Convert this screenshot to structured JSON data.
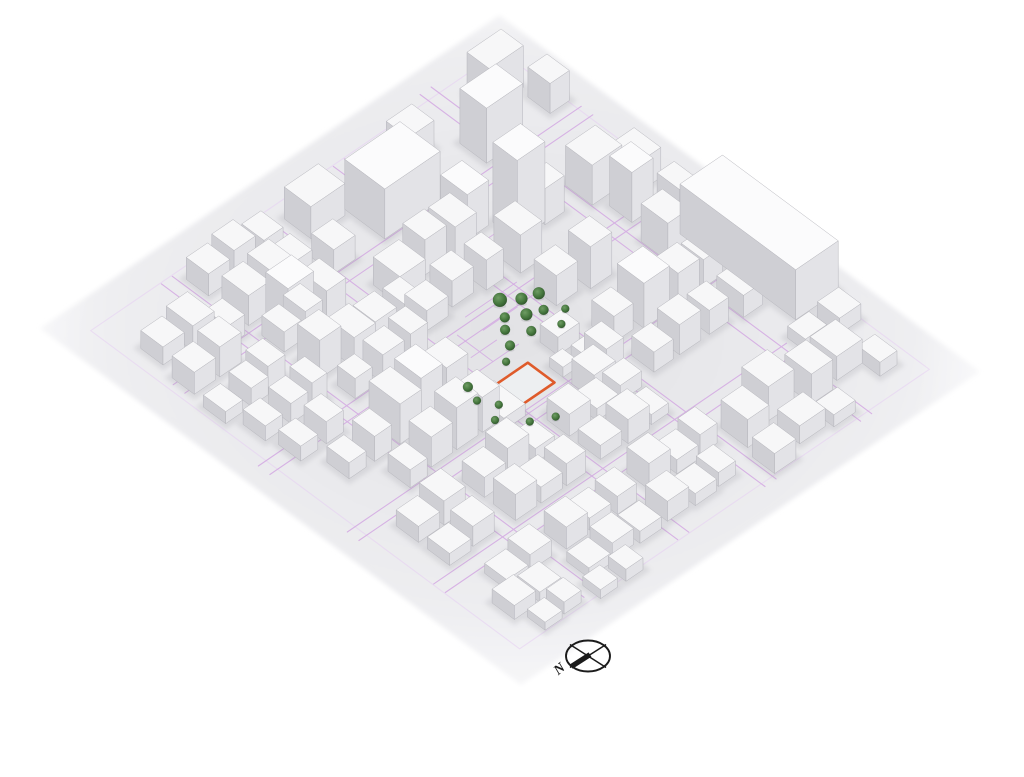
{
  "meta": {
    "description": "Axonometric 3D city-context massing model with highlighted site parcel, central tree cluster and north compass",
    "view": "aerial-axonometric"
  },
  "compass": {
    "cx": 588,
    "cy": 656,
    "rx": 22,
    "ry": 15.5,
    "label": "N"
  },
  "palette": {
    "background": "#ffffff",
    "ground_center": "#e2e2e5",
    "ground_mid": "#ededf0",
    "ground_edge": "#fbfbfc",
    "building_top": "#f7f7f8",
    "building_top_tall": "#fbfbfc",
    "building_left": "#cfcfd4",
    "building_right": "#e3e3e7",
    "building_edge": "#b6b6bc",
    "road": "#d2a4e2",
    "road_light": "#e6cdf2",
    "site_outline": "#df5b2b",
    "site_fill": "#edeff1",
    "tree": "#47793f",
    "tree_light": "#6f9c64",
    "tree_dark": "#2c5029",
    "shadow": "#8f8f98",
    "compass_ink": "#1b1b1b"
  },
  "projection": {
    "left": [
      75,
      330
    ],
    "top": [
      500,
      40
    ],
    "right": [
      920,
      330
    ],
    "bottom": [
      520,
      660
    ]
  },
  "site": {
    "u": 0.42,
    "v": 0.54,
    "w": 0.08,
    "d": 0.06
  },
  "roads": {
    "v_streets": [
      {
        "v": 0.205,
        "u0": 0.03,
        "u1": 0.99
      },
      {
        "v": 0.425,
        "u0": 0.0,
        "u1": 0.99
      },
      {
        "v": 0.625,
        "u0": 0.0,
        "u1": 0.87
      },
      {
        "v": 0.8,
        "u0": 0.02,
        "u1": 0.85
      }
    ],
    "u_streets": [
      {
        "u": 0.195,
        "v0": 0.02,
        "v1": 0.97
      },
      {
        "u": 0.405,
        "v0": 0.03,
        "v1": 0.98
      },
      {
        "u": 0.6,
        "v0": 0.02,
        "v1": 0.99
      },
      {
        "u": 0.825,
        "v0": 0.0,
        "v1": 0.99
      }
    ],
    "perimeter_inset": 0.018
  },
  "details": [
    [
      0.5,
      0.4,
      0.62,
      0.4
    ],
    [
      0.5,
      0.44,
      0.58,
      0.44
    ],
    [
      0.42,
      0.5,
      0.52,
      0.5
    ],
    [
      0.44,
      0.47,
      0.5,
      0.47
    ],
    [
      0.55,
      0.55,
      0.6,
      0.55
    ],
    [
      0.36,
      0.62,
      0.46,
      0.62
    ],
    [
      0.52,
      0.6,
      0.52,
      0.66
    ],
    [
      0.58,
      0.5,
      0.58,
      0.56
    ],
    [
      0.62,
      0.3,
      0.7,
      0.3
    ],
    [
      0.3,
      0.44,
      0.38,
      0.44
    ],
    [
      0.46,
      0.42,
      0.46,
      0.5
    ],
    [
      0.6,
      0.58,
      0.66,
      0.58
    ]
  ],
  "trees": [
    [
      0.56,
      0.42,
      7
    ],
    [
      0.59,
      0.44,
      6
    ],
    [
      0.62,
      0.45,
      6
    ],
    [
      0.54,
      0.45,
      5
    ],
    [
      0.57,
      0.47,
      6
    ],
    [
      0.6,
      0.48,
      5
    ],
    [
      0.52,
      0.47,
      5
    ],
    [
      0.55,
      0.5,
      5
    ],
    [
      0.5,
      0.5,
      5
    ],
    [
      0.47,
      0.52,
      4
    ],
    [
      0.38,
      0.52,
      5
    ],
    [
      0.37,
      0.55,
      4
    ],
    [
      0.39,
      0.58,
      4
    ],
    [
      0.36,
      0.6,
      4
    ],
    [
      0.4,
      0.64,
      4
    ],
    [
      0.44,
      0.66,
      4
    ],
    [
      0.6,
      0.52,
      4
    ],
    [
      0.63,
      0.5,
      4
    ]
  ],
  "buildings": [
    [
      0.87,
      0.05,
      0.08,
      0.05,
      42
    ],
    [
      0.78,
      0.12,
      0.085,
      0.06,
      55
    ],
    [
      0.94,
      0.12,
      0.045,
      0.05,
      30
    ],
    [
      0.69,
      0.28,
      0.065,
      0.055,
      80
    ],
    [
      0.75,
      0.3,
      0.045,
      0.04,
      36
    ],
    [
      0.53,
      0.1,
      0.13,
      0.09,
      50
    ],
    [
      0.44,
      0.05,
      0.08,
      0.06,
      32
    ],
    [
      0.68,
      0.05,
      0.06,
      0.05,
      28
    ],
    [
      0.63,
      0.22,
      0.05,
      0.06,
      45
    ],
    [
      0.25,
      0.19,
      0.06,
      0.05,
      48
    ],
    [
      0.84,
      0.3,
      0.07,
      0.06,
      40
    ],
    [
      0.86,
      0.38,
      0.05,
      0.05,
      50
    ],
    [
      0.92,
      0.33,
      0.05,
      0.06,
      30
    ],
    [
      0.93,
      0.42,
      0.04,
      0.05,
      26
    ],
    [
      0.84,
      0.47,
      0.05,
      0.06,
      38
    ],
    [
      0.9,
      0.5,
      0.1,
      0.26,
      50
    ],
    [
      0.84,
      0.56,
      0.045,
      0.05,
      28
    ],
    [
      0.84,
      0.64,
      0.045,
      0.06,
      22
    ],
    [
      0.86,
      0.78,
      0.05,
      0.04,
      12
    ],
    [
      0.93,
      0.78,
      0.05,
      0.05,
      16
    ],
    [
      0.85,
      0.84,
      0.06,
      0.06,
      24
    ],
    [
      0.78,
      0.85,
      0.05,
      0.06,
      30
    ],
    [
      0.7,
      0.83,
      0.06,
      0.06,
      34
    ],
    [
      0.63,
      0.85,
      0.05,
      0.06,
      28
    ],
    [
      0.91,
      0.89,
      0.04,
      0.05,
      14
    ],
    [
      0.7,
      0.91,
      0.06,
      0.05,
      18
    ],
    [
      0.62,
      0.93,
      0.05,
      0.05,
      20
    ],
    [
      0.77,
      0.93,
      0.05,
      0.04,
      12
    ],
    [
      0.7,
      0.55,
      0.06,
      0.06,
      45
    ],
    [
      0.77,
      0.57,
      0.05,
      0.05,
      38
    ],
    [
      0.64,
      0.33,
      0.05,
      0.06,
      38
    ],
    [
      0.7,
      0.44,
      0.05,
      0.05,
      42
    ],
    [
      0.63,
      0.43,
      0.05,
      0.05,
      30
    ],
    [
      0.64,
      0.55,
      0.045,
      0.05,
      26
    ],
    [
      0.7,
      0.64,
      0.05,
      0.05,
      30
    ],
    [
      0.77,
      0.64,
      0.045,
      0.05,
      24
    ],
    [
      0.64,
      0.64,
      0.045,
      0.05,
      20
    ],
    [
      0.44,
      0.25,
      0.06,
      0.06,
      28
    ],
    [
      0.52,
      0.24,
      0.05,
      0.05,
      35
    ],
    [
      0.57,
      0.25,
      0.05,
      0.06,
      40
    ],
    [
      0.43,
      0.33,
      0.05,
      0.05,
      20
    ],
    [
      0.5,
      0.32,
      0.05,
      0.05,
      26
    ],
    [
      0.57,
      0.33,
      0.04,
      0.05,
      30
    ],
    [
      0.55,
      0.52,
      0.05,
      0.04,
      18
    ],
    [
      0.52,
      0.57,
      0.03,
      0.03,
      10
    ],
    [
      0.56,
      0.58,
      0.035,
      0.04,
      14
    ],
    [
      0.36,
      0.55,
      0.05,
      0.07,
      12
    ],
    [
      0.52,
      0.62,
      0.05,
      0.05,
      25
    ],
    [
      0.57,
      0.6,
      0.04,
      0.05,
      30
    ],
    [
      0.55,
      0.66,
      0.05,
      0.04,
      16
    ],
    [
      0.44,
      0.64,
      0.04,
      0.04,
      8
    ],
    [
      0.22,
      0.04,
      0.05,
      0.05,
      22
    ],
    [
      0.28,
      0.04,
      0.05,
      0.05,
      28
    ],
    [
      0.34,
      0.05,
      0.045,
      0.05,
      24
    ],
    [
      0.22,
      0.12,
      0.05,
      0.06,
      30
    ],
    [
      0.28,
      0.12,
      0.05,
      0.05,
      35
    ],
    [
      0.34,
      0.12,
      0.04,
      0.05,
      26
    ],
    [
      0.22,
      0.21,
      0.04,
      0.05,
      20
    ],
    [
      0.27,
      0.21,
      0.04,
      0.05,
      26
    ],
    [
      0.32,
      0.2,
      0.045,
      0.06,
      32
    ],
    [
      0.22,
      0.29,
      0.05,
      0.05,
      38
    ],
    [
      0.28,
      0.3,
      0.05,
      0.06,
      30
    ],
    [
      0.34,
      0.3,
      0.05,
      0.05,
      25
    ],
    [
      0.23,
      0.37,
      0.04,
      0.04,
      20
    ],
    [
      0.29,
      0.37,
      0.05,
      0.045,
      28
    ],
    [
      0.35,
      0.37,
      0.04,
      0.05,
      33
    ],
    [
      0.41,
      0.14,
      0.05,
      0.05,
      24
    ],
    [
      0.41,
      0.3,
      0.04,
      0.05,
      22
    ],
    [
      0.05,
      0.1,
      0.05,
      0.05,
      18
    ],
    [
      0.11,
      0.1,
      0.05,
      0.06,
      25
    ],
    [
      0.04,
      0.18,
      0.05,
      0.05,
      22
    ],
    [
      0.1,
      0.18,
      0.05,
      0.05,
      30
    ],
    [
      0.03,
      0.26,
      0.04,
      0.05,
      12
    ],
    [
      0.09,
      0.26,
      0.04,
      0.05,
      18
    ],
    [
      0.14,
      0.25,
      0.04,
      0.05,
      22
    ],
    [
      0.05,
      0.33,
      0.04,
      0.05,
      15
    ],
    [
      0.11,
      0.33,
      0.04,
      0.05,
      20
    ],
    [
      0.16,
      0.33,
      0.035,
      0.05,
      26
    ],
    [
      0.06,
      0.4,
      0.04,
      0.05,
      15
    ],
    [
      0.12,
      0.4,
      0.04,
      0.05,
      22
    ],
    [
      0.16,
      0.14,
      0.04,
      0.05,
      20
    ],
    [
      0.21,
      0.46,
      0.05,
      0.07,
      40
    ],
    [
      0.27,
      0.46,
      0.05,
      0.06,
      45
    ],
    [
      0.33,
      0.47,
      0.05,
      0.05,
      38
    ],
    [
      0.21,
      0.55,
      0.05,
      0.05,
      30
    ],
    [
      0.27,
      0.55,
      0.05,
      0.05,
      42
    ],
    [
      0.33,
      0.55,
      0.04,
      0.05,
      35
    ],
    [
      0.15,
      0.48,
      0.04,
      0.05,
      25
    ],
    [
      0.15,
      0.56,
      0.04,
      0.05,
      18
    ],
    [
      0.09,
      0.48,
      0.04,
      0.05,
      16
    ],
    [
      0.07,
      0.655,
      0.05,
      0.05,
      16
    ],
    [
      0.13,
      0.65,
      0.05,
      0.055,
      24
    ],
    [
      0.225,
      0.655,
      0.05,
      0.05,
      20
    ],
    [
      0.285,
      0.65,
      0.05,
      0.05,
      30
    ],
    [
      0.345,
      0.655,
      0.045,
      0.05,
      14
    ],
    [
      0.43,
      0.65,
      0.05,
      0.05,
      22
    ],
    [
      0.49,
      0.655,
      0.05,
      0.05,
      12
    ],
    [
      0.07,
      0.725,
      0.05,
      0.05,
      12
    ],
    [
      0.13,
      0.72,
      0.05,
      0.05,
      20
    ],
    [
      0.225,
      0.725,
      0.05,
      0.05,
      26
    ],
    [
      0.285,
      0.72,
      0.05,
      0.055,
      16
    ],
    [
      0.345,
      0.725,
      0.045,
      0.05,
      22
    ],
    [
      0.43,
      0.72,
      0.05,
      0.05,
      14
    ],
    [
      0.49,
      0.725,
      0.05,
      0.05,
      24
    ],
    [
      0.55,
      0.72,
      0.04,
      0.05,
      10
    ],
    [
      0.1,
      0.825,
      0.05,
      0.05,
      10
    ],
    [
      0.16,
      0.82,
      0.05,
      0.05,
      16
    ],
    [
      0.24,
      0.825,
      0.05,
      0.05,
      22
    ],
    [
      0.3,
      0.82,
      0.05,
      0.05,
      12
    ],
    [
      0.36,
      0.825,
      0.045,
      0.05,
      18
    ],
    [
      0.44,
      0.82,
      0.05,
      0.05,
      26
    ],
    [
      0.5,
      0.825,
      0.05,
      0.05,
      14
    ],
    [
      0.56,
      0.82,
      0.04,
      0.05,
      20
    ],
    [
      0.22,
      0.895,
      0.05,
      0.05,
      10
    ],
    [
      0.28,
      0.89,
      0.05,
      0.05,
      16
    ],
    [
      0.34,
      0.895,
      0.05,
      0.05,
      12
    ],
    [
      0.41,
      0.89,
      0.05,
      0.05,
      20
    ],
    [
      0.47,
      0.895,
      0.05,
      0.05,
      12
    ],
    [
      0.53,
      0.89,
      0.04,
      0.05,
      14
    ],
    [
      0.06,
      0.88,
      0.05,
      0.05,
      14
    ],
    [
      0.12,
      0.88,
      0.05,
      0.05,
      10
    ],
    [
      0.08,
      0.94,
      0.04,
      0.04,
      8
    ],
    [
      0.13,
      0.935,
      0.04,
      0.04,
      12
    ],
    [
      0.2,
      0.95,
      0.04,
      0.04,
      9
    ],
    [
      0.26,
      0.95,
      0.04,
      0.04,
      12
    ]
  ]
}
